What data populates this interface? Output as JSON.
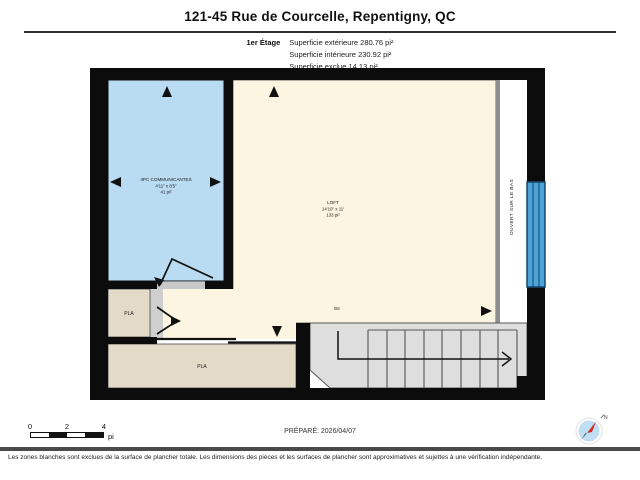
{
  "header": {
    "title": "121-45 Rue de Courcelle, Repentigny, QC",
    "floor_label": "1er Étage",
    "stats": [
      {
        "label": "Superficie extérieure",
        "value": "280.76 pi²"
      },
      {
        "label": "Superficie intérieure",
        "value": "230.92 pi²"
      },
      {
        "label": "Superficie exclue",
        "value": "14.13 pi²"
      }
    ]
  },
  "plan": {
    "rooms": {
      "bathroom": {
        "name": "4PC COMMUNICANTES",
        "dims": "4'11\" x 8'5\"",
        "area": "41 pi²"
      },
      "loft": {
        "name": "LOFT",
        "dims": "14'10\" x 11'",
        "area": "133 pi²"
      },
      "closet_upper": {
        "name": "PLA"
      },
      "closet_lower": {
        "name": "PLA"
      },
      "open_to_below": {
        "name": "OUVERT SUR LE BAS"
      },
      "stair_note": "BS"
    },
    "colors": {
      "wall": "#0c0c0c",
      "bathroom_fill": "#b9dcf3",
      "loft_fill": "#fcf5e1",
      "closet_fill": "#e4dac8",
      "stairs_fill": "#dedede",
      "window": "#4da3d8",
      "open_area": "#ffffff"
    }
  },
  "scale_bar": {
    "ticks": [
      "0",
      "2",
      "4"
    ],
    "unit": "pi"
  },
  "footer": {
    "prepared": "PRÉPARÉ: 2026/04/07",
    "compass": "N",
    "disclaimer": "Les zones blanches sont exclues de la surface de plancher totale. Les dimensions des pièces et les surfaces de plancher sont approximatives et sujettes à une vérification indépendante."
  }
}
